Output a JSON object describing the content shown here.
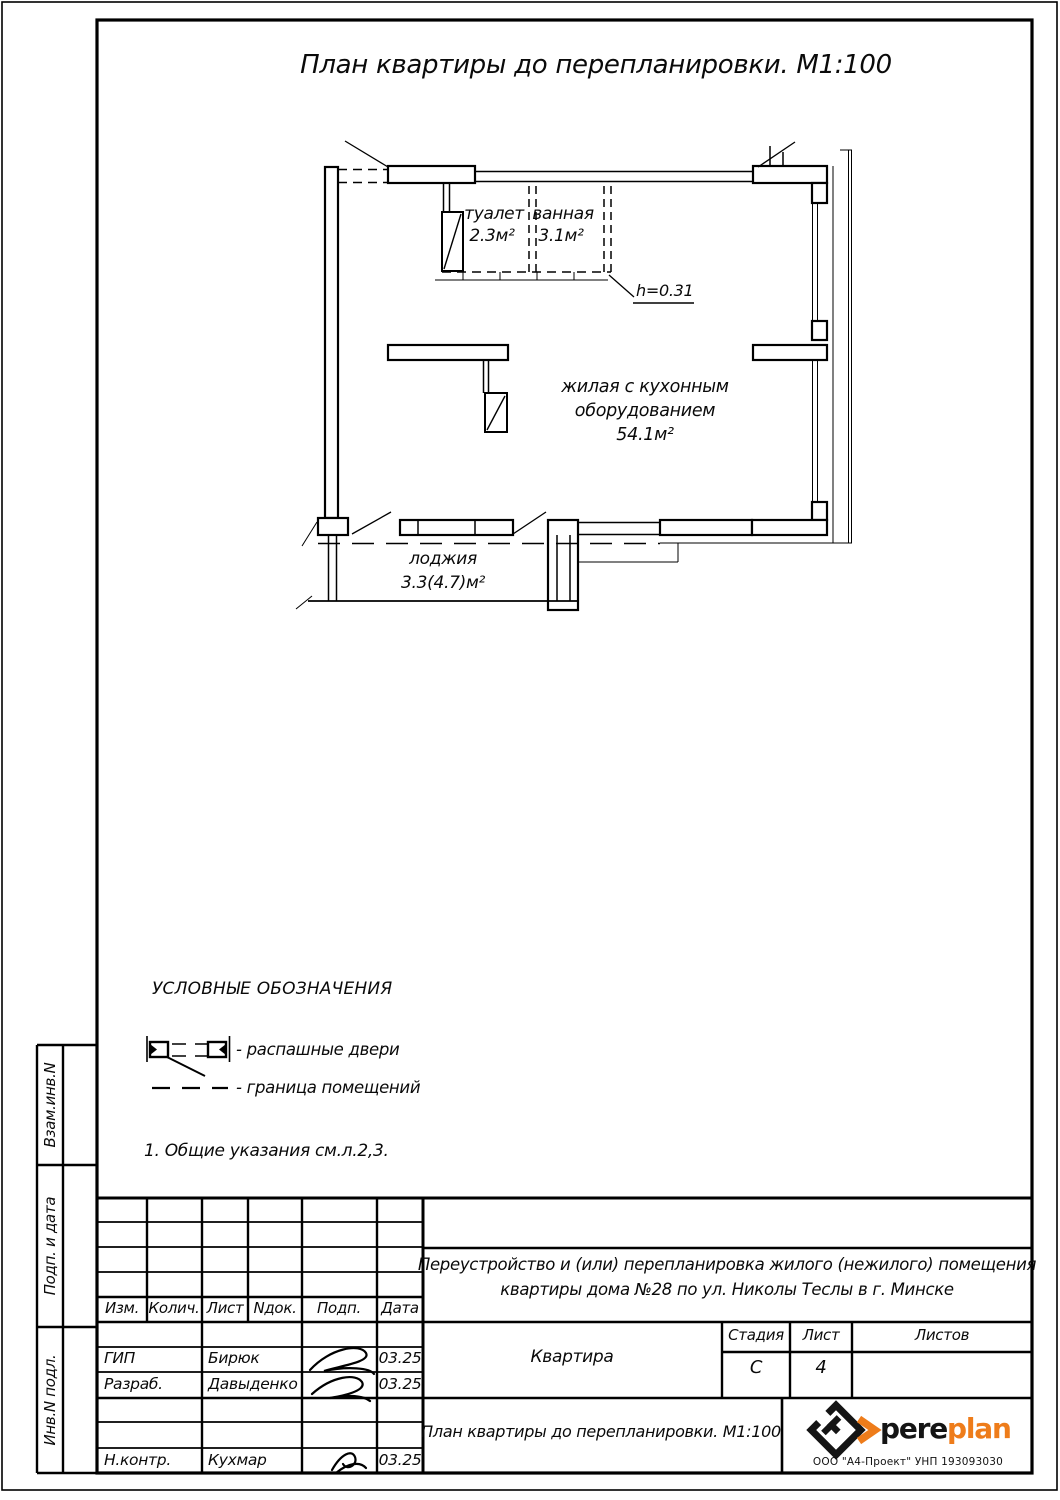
{
  "sheet": {
    "title": "План квартиры до перепланировки. М1:100"
  },
  "plan": {
    "rooms": {
      "toilet": {
        "name": "туалет",
        "area": "2.3м²"
      },
      "bath": {
        "name": "ванная",
        "area": "3.1м²"
      },
      "living": {
        "line1": "жилая с кухонным",
        "line2": "оборудованием",
        "area": "54.1м²"
      },
      "loggia": {
        "name": "лоджия",
        "area": "3.3(4.7)м²"
      }
    },
    "height_note": "h=0.31"
  },
  "legend": {
    "title": "УСЛОВНЫЕ ОБОЗНАЧЕНИЯ",
    "door_item": "- распашные двери",
    "boundary_item": "- граница помещений",
    "note": "1. Общие указания см.л.2,3."
  },
  "titleblock": {
    "columns": [
      "Изм.",
      "Колич.",
      "Лист",
      "Nдок.",
      "Подп.",
      "Дата"
    ],
    "staff": [
      {
        "role": "ГИП",
        "name": "Бирюк",
        "date": "03.25"
      },
      {
        "role": "Разраб.",
        "name": "Давыденко",
        "date": "03.25"
      },
      {
        "role": "Н.контр.",
        "name": "Кухмар",
        "date": "03.25"
      }
    ],
    "project_line1": "Переустройство и (или) перепланировка жилого (нежилого) помещения",
    "project_line2": "квартиры дома №28 по ул. Николы Теслы в г. Минске",
    "object_name": "Квартира",
    "stage_label": "Стадия",
    "sheet_label": "Лист",
    "sheets_label": "Листов",
    "stage": "С",
    "sheet_number": "4",
    "drawing_title": "План квартиры до перепланировки. М1:100",
    "sidebar_labels": [
      "Взам.инв.N",
      "Подп. и дата",
      "Инв.N подл."
    ]
  },
  "logo": {
    "text_black": "pere",
    "text_orange": "plan",
    "company": "ООО \"А4-Проект\" УНП 193093030",
    "accent_color": "#EE7C1A",
    "ink_color": "#141414"
  }
}
